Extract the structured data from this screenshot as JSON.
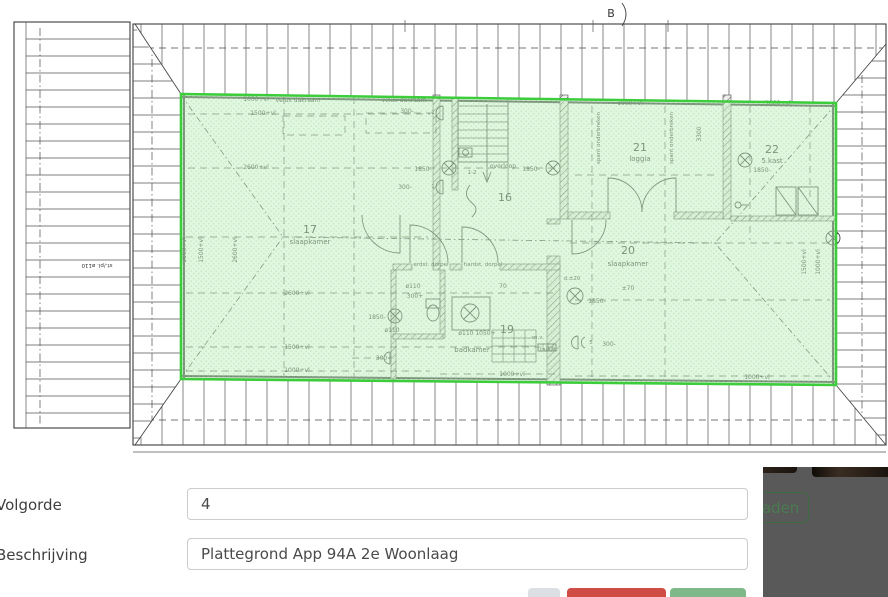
{
  "colors": {
    "highlight_border": "#3ccc3c",
    "highlight_fill": "#c8f0c6",
    "backdrop": "#595959",
    "backdrop_link_green": "#4a7c50",
    "button_danger": "#d04d45",
    "button_success": "#80b989",
    "button_neutral": "#dce0e5"
  },
  "modal": {
    "fields": [
      {
        "label": "Volgorde",
        "value": "4"
      },
      {
        "label": "Beschrijving",
        "value": "Plattegrond App 94A 2e Woonlaag"
      }
    ],
    "action_buttons": [
      {
        "name": "neutral",
        "label": ""
      },
      {
        "name": "delete",
        "label": ""
      },
      {
        "name": "save",
        "label": ""
      }
    ]
  },
  "backdrop": {
    "partial_button_label": "oaden"
  },
  "plan": {
    "section_mark": "B",
    "labels": [
      {
        "text": "B",
        "x": 611,
        "y": 17,
        "s": 11
      },
      {
        "text": "1000+vl",
        "x": 256,
        "y": 101
      },
      {
        "text": "velux dakraam",
        "x": 298,
        "y": 102
      },
      {
        "text": "velux dakraam",
        "x": 404,
        "y": 102
      },
      {
        "text": "1000+vl",
        "x": 630,
        "y": 105
      },
      {
        "text": "1000+vl",
        "x": 778,
        "y": 105
      },
      {
        "text": "1500+vl",
        "x": 263,
        "y": 115
      },
      {
        "text": "300-",
        "x": 407,
        "y": 113
      },
      {
        "text": "2600+vl",
        "x": 256,
        "y": 169
      },
      {
        "text": "300-",
        "x": 405,
        "y": 189
      },
      {
        "text": "1850-",
        "x": 423,
        "y": 171
      },
      {
        "text": "1850-",
        "x": 531,
        "y": 171
      },
      {
        "text": "overloop",
        "x": 503,
        "y": 168
      },
      {
        "text": "16",
        "x": 505,
        "y": 201,
        "s": 11
      },
      {
        "text": "17",
        "x": 310,
        "y": 233,
        "s": 11
      },
      {
        "text": "slaapkamer",
        "x": 310,
        "y": 244,
        "s": 7
      },
      {
        "text": "21",
        "x": 640,
        "y": 151,
        "s": 11
      },
      {
        "text": "loggia",
        "x": 640,
        "y": 161,
        "s": 7
      },
      {
        "text": "22",
        "x": 772,
        "y": 153,
        "s": 11
      },
      {
        "text": "5.kast",
        "x": 772,
        "y": 163,
        "s": 7
      },
      {
        "text": "1850-",
        "x": 762,
        "y": 172
      },
      {
        "text": "spant onderbreken",
        "x": 600,
        "y": 138,
        "r": -90,
        "s": 5.5
      },
      {
        "text": "spant onderbreken",
        "x": 673,
        "y": 138,
        "r": -90,
        "s": 5.5
      },
      {
        "text": "3300",
        "x": 701,
        "y": 134,
        "r": -90
      },
      {
        "text": "20",
        "x": 628,
        "y": 254,
        "s": 11
      },
      {
        "text": "slaapkamer",
        "x": 628,
        "y": 266,
        "s": 7
      },
      {
        "text": "±70",
        "x": 628,
        "y": 290
      },
      {
        "text": "d.±20",
        "x": 572,
        "y": 280,
        "s": 5.5
      },
      {
        "text": "1850-",
        "x": 597,
        "y": 303
      },
      {
        "text": "erdst. dorpel",
        "x": 431,
        "y": 266,
        "s": 5.5
      },
      {
        "text": "hardst. dorpel",
        "x": 483,
        "y": 266,
        "s": 5.5
      },
      {
        "text": "ø110",
        "x": 413,
        "y": 288
      },
      {
        "text": "300+",
        "x": 415,
        "y": 298
      },
      {
        "text": "1850-",
        "x": 377,
        "y": 319
      },
      {
        "text": "ø110",
        "x": 392,
        "y": 332
      },
      {
        "text": "ø110 1050+",
        "x": 477,
        "y": 335
      },
      {
        "text": "19",
        "x": 507,
        "y": 333,
        "s": 11
      },
      {
        "text": "badkamer",
        "x": 472,
        "y": 352,
        "s": 7
      },
      {
        "text": "m.v.",
        "x": 538,
        "y": 339,
        "s": 5.5
      },
      {
        "text": "radiat.",
        "x": 549,
        "y": 351,
        "s": 5.5
      },
      {
        "text": "300-",
        "x": 609,
        "y": 346
      },
      {
        "text": "2600+vl",
        "x": 297,
        "y": 295
      },
      {
        "text": "1500+vl",
        "x": 297,
        "y": 349
      },
      {
        "text": "300+",
        "x": 384,
        "y": 360
      },
      {
        "text": "1000+vl",
        "x": 297,
        "y": 372
      },
      {
        "text": "1000+vl",
        "x": 512,
        "y": 376
      },
      {
        "text": "1000+vl",
        "x": 757,
        "y": 379
      },
      {
        "text": "1000+vl",
        "x": 186,
        "y": 250,
        "r": -90
      },
      {
        "text": "1500+vl",
        "x": 203,
        "y": 250,
        "r": -90
      },
      {
        "text": "2600+vl",
        "x": 237,
        "y": 250,
        "r": -90
      },
      {
        "text": "1500+vl",
        "x": 806,
        "y": 262,
        "r": -90
      },
      {
        "text": "1000+vl",
        "x": 820,
        "y": 262,
        "r": -90
      },
      {
        "text": "st./pl. ø110",
        "x": 97,
        "y": 264,
        "r": 180,
        "s": 5.5
      },
      {
        "text": "1-2",
        "x": 472,
        "y": 174,
        "s": 5.5
      },
      {
        "text": "70",
        "x": 503,
        "y": 288
      },
      {
        "text": "1",
        "x": 433,
        "y": 114,
        "s": 5.5
      },
      {
        "text": "1",
        "x": 433,
        "y": 188,
        "s": 5.5
      },
      {
        "text": "5",
        "x": 591,
        "y": 344,
        "s": 5.5
      }
    ]
  }
}
